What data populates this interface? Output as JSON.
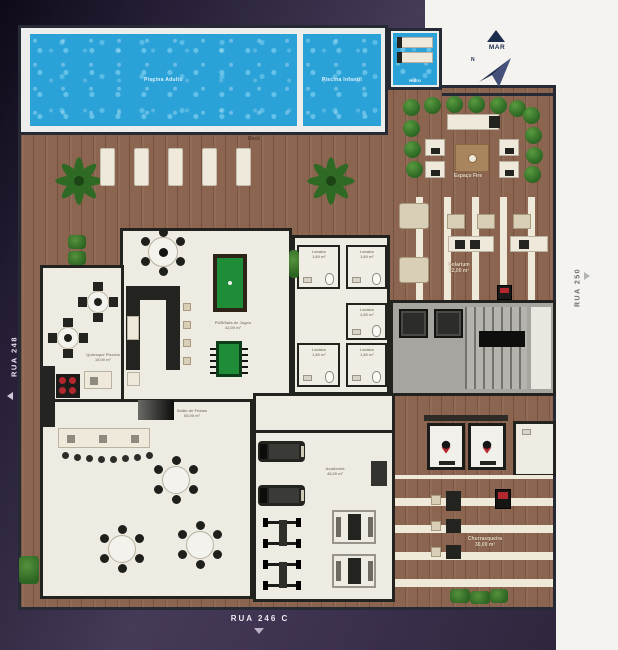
{
  "colors": {
    "purple_bg_dark": "#0e0a18",
    "purple_bg": "#453a57",
    "purple_bg_bottom": "#2c2337",
    "paper_white": "#f5f3ef",
    "wood": "#8b6550",
    "pool_blue": "#2aa2d8",
    "room_floor": "#edebe2",
    "felt_green": "#1f8c38",
    "bush_green": "#2f6b25",
    "accent_red": "#b3282e",
    "navy": "#1d2b4c"
  },
  "compass": {
    "sea_label": "MAR",
    "north_label": "N"
  },
  "streets": {
    "left": "RUA 248",
    "right": "RUA 250",
    "bottom": "RUA 246 C"
  },
  "pools": {
    "adult_label": "Piscina Adulto",
    "kids_label": "Piscina Infantil",
    "spa_label": "Hidro"
  },
  "areas": {
    "deck": {
      "label": "Deck"
    },
    "fire_lounge": {
      "label": "Espaço Fire"
    },
    "solarium": {
      "label": "Solarium",
      "area": "22,00 m²"
    },
    "quiosque": {
      "label": "Quiosque Piscina",
      "area": "15,00 m²"
    },
    "pub": {
      "label": "PUB/Sala de Jogos",
      "area": "42,00 m²"
    },
    "lavabo_top_left": {
      "label": "Lavabo",
      "area": "1,80 m²"
    },
    "lavabo_top_right": {
      "label": "Lavabo",
      "area": "1,80 m²"
    },
    "lavabo_mid": {
      "label": "Lavabo",
      "area": "2,50 m²"
    },
    "lavabo_bottom_left": {
      "label": "Lavabo",
      "area": "1,80 m²"
    },
    "lavabo_bottom_right": {
      "label": "Lavabo",
      "area": "1,80 m²"
    },
    "salao": {
      "label": "Salão de Festas",
      "area": "65,00 m²"
    },
    "academia": {
      "label": "Academia",
      "area": "46,00 m²"
    },
    "churrasqueira": {
      "label": "Churrasqueira",
      "area": "30,00 m²"
    }
  }
}
